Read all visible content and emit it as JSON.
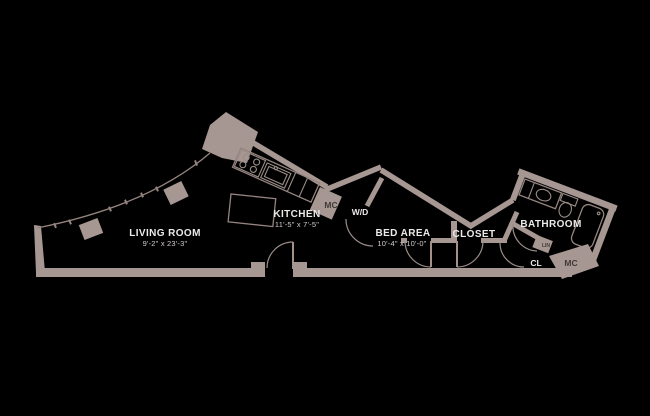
{
  "rooms": {
    "living_room": {
      "name": "LIVING ROOM",
      "dims": "9'-2\" x 23'-3\""
    },
    "kitchen": {
      "name": "KITCHEN",
      "dims": "11'-5\" x 7'-5\""
    },
    "bed_area": {
      "name": "BED AREA",
      "dims": "10'-4\" x 10'-0\""
    },
    "closet": {
      "name": "CLOSET"
    },
    "bathroom": {
      "name": "BATHROOM"
    }
  },
  "labels": {
    "washer_dryer": "W/D",
    "kitchen_mech": "MC",
    "bath_mech": "MC",
    "bath_closet": "CL",
    "linen": "LIN"
  },
  "fixtures": [
    "window-wall",
    "structural-columns",
    "range-4-burner",
    "kitchen-sink",
    "kitchen-island",
    "entry-door",
    "closet-double-doors",
    "bathroom-vanity-sink",
    "toilet",
    "bathtub"
  ],
  "colors": {
    "background": "#000000",
    "walls": "#a79792",
    "fixture_lines": "#94847f",
    "room_text": "#eceae9",
    "dimension_text": "#d2cccb",
    "label_on_wall_text": "#423a37"
  }
}
